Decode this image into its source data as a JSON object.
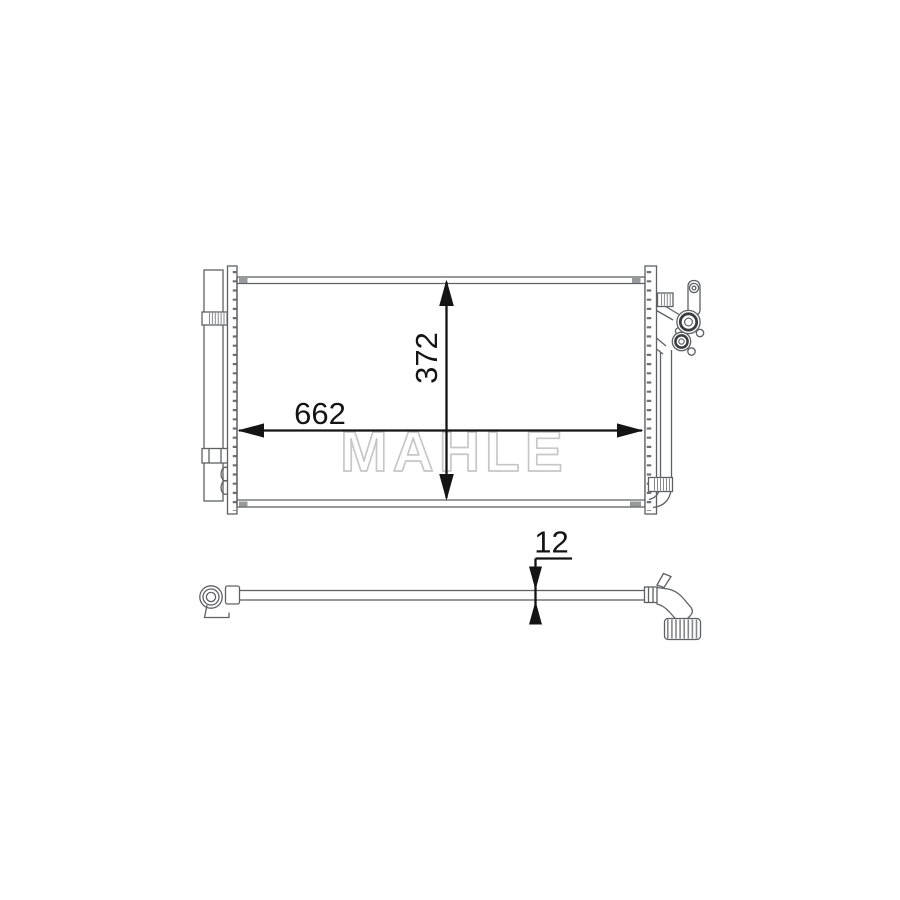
{
  "watermark": {
    "text": "MAHLE"
  },
  "dimensions": {
    "width": {
      "value": "662"
    },
    "height": {
      "value": "372"
    },
    "depth": {
      "value": "12"
    }
  },
  "colors": {
    "background": "#ffffff",
    "outline": "#5f6064",
    "outline_dark": "#3c3d41",
    "stub_fill": "#98999d",
    "hatch": "#85868a",
    "dimension": "#141414",
    "watermark": "#c7c7c7"
  }
}
